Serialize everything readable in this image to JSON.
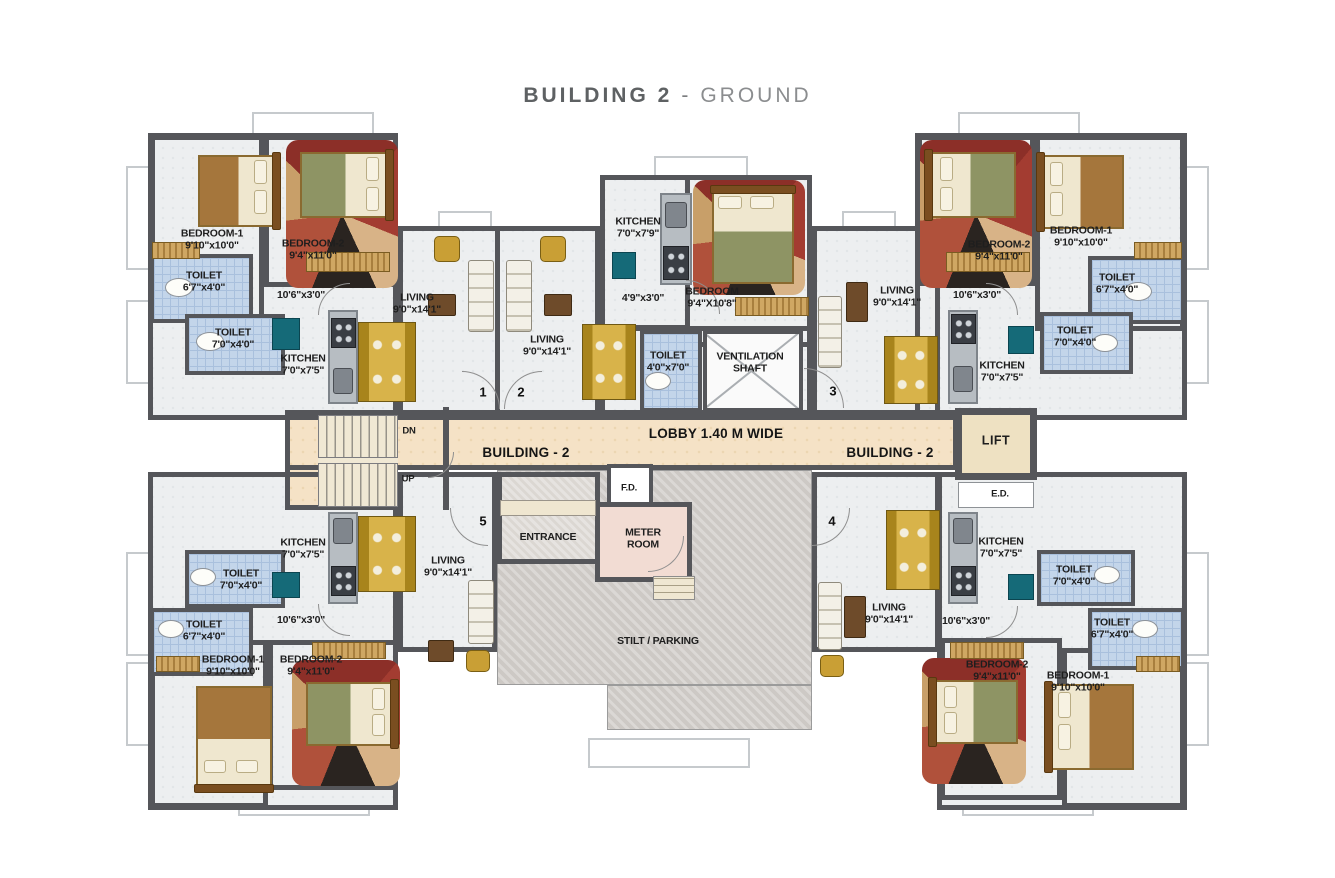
{
  "title": {
    "building": "BUILDING 2",
    "separator": "-",
    "floor": "GROUND"
  },
  "colors": {
    "wall": "#55565a",
    "lobby_floor": "#f5e2c6",
    "stilt_floor": "#cdc9c5",
    "toilet_tile": "#c3d5ea",
    "meter_room": "#f2dcd3",
    "lift_floor": "#eee1c2",
    "accent_gold": "#d8b34a",
    "accent_teal": "#156a78",
    "title_dark": "#5e6163",
    "title_light": "#8b8d8f"
  },
  "floorplan": {
    "unit_doors": [
      {
        "number": "1",
        "x": 483,
        "y": 392
      },
      {
        "number": "2",
        "x": 521,
        "y": 392
      },
      {
        "number": "3",
        "x": 833,
        "y": 391
      },
      {
        "number": "4",
        "x": 832,
        "y": 521
      },
      {
        "number": "5",
        "x": 483,
        "y": 521
      }
    ],
    "labels": [
      {
        "lines": [
          "BEDROOM-1",
          "9'10\"x10'0\""
        ],
        "x": 212,
        "y": 240,
        "style": "room"
      },
      {
        "lines": [
          "BEDROOM-2",
          "9'4\"x11'0\""
        ],
        "x": 313,
        "y": 250,
        "style": "room"
      },
      {
        "lines": [
          "TOILET",
          "6'7\"x4'0\""
        ],
        "x": 204,
        "y": 282,
        "style": "room"
      },
      {
        "lines": [
          "TOILET",
          "7'0\"x4'0\""
        ],
        "x": 233,
        "y": 339,
        "style": "room"
      },
      {
        "lines": [
          "10'6\"x3'0\""
        ],
        "x": 301,
        "y": 295,
        "style": "room"
      },
      {
        "lines": [
          "KITCHEN",
          "7'0\"x7'5\""
        ],
        "x": 303,
        "y": 365,
        "style": "room"
      },
      {
        "lines": [
          "LIVING",
          "9'0\"x14'1\""
        ],
        "x": 417,
        "y": 304,
        "style": "room"
      },
      {
        "lines": [
          "LIVING",
          "9'0\"x14'1\""
        ],
        "x": 547,
        "y": 346,
        "style": "room"
      },
      {
        "lines": [
          "KITCHEN",
          "7'0\"x7'9\""
        ],
        "x": 638,
        "y": 228,
        "style": "room"
      },
      {
        "lines": [
          "4'9\"x3'0\""
        ],
        "x": 643,
        "y": 298,
        "style": "room"
      },
      {
        "lines": [
          "BEDROOM",
          "9'4\"X10'8\""
        ],
        "x": 712,
        "y": 298,
        "style": "room"
      },
      {
        "lines": [
          "TOILET",
          "4'0\"x7'0\""
        ],
        "x": 668,
        "y": 362,
        "style": "room"
      },
      {
        "lines": [
          "VENTILATION",
          "SHAFT"
        ],
        "x": 750,
        "y": 363,
        "style": "room"
      },
      {
        "lines": [
          "LIVING",
          "9'0\"x14'1\""
        ],
        "x": 897,
        "y": 297,
        "style": "room"
      },
      {
        "lines": [
          "10'6\"x3'0\""
        ],
        "x": 977,
        "y": 295,
        "style": "room"
      },
      {
        "lines": [
          "BEDROOM-2",
          "9'4\"x11'0\""
        ],
        "x": 999,
        "y": 251,
        "style": "room"
      },
      {
        "lines": [
          "BEDROOM-1",
          "9'10\"x10'0\""
        ],
        "x": 1081,
        "y": 237,
        "style": "room"
      },
      {
        "lines": [
          "TOILET",
          "6'7\"x4'0\""
        ],
        "x": 1117,
        "y": 284,
        "style": "room"
      },
      {
        "lines": [
          "TOILET",
          "7'0\"x4'0\""
        ],
        "x": 1075,
        "y": 337,
        "style": "room"
      },
      {
        "lines": [
          "KITCHEN",
          "7'0\"x7'5\""
        ],
        "x": 1002,
        "y": 372,
        "style": "room"
      },
      {
        "lines": [
          "LOBBY 1.40 M WIDE"
        ],
        "x": 716,
        "y": 434,
        "style": "big"
      },
      {
        "lines": [
          "BUILDING - 2"
        ],
        "x": 526,
        "y": 453,
        "style": "big"
      },
      {
        "lines": [
          "BUILDING - 2"
        ],
        "x": 890,
        "y": 453,
        "style": "big"
      },
      {
        "lines": [
          "LIFT"
        ],
        "x": 996,
        "y": 441,
        "style": "med"
      },
      {
        "lines": [
          "DN"
        ],
        "x": 409,
        "y": 431,
        "style": "sm"
      },
      {
        "lines": [
          "UP"
        ],
        "x": 408,
        "y": 479,
        "style": "sm"
      },
      {
        "lines": [
          "F.D."
        ],
        "x": 629,
        "y": 488,
        "style": "sm"
      },
      {
        "lines": [
          "E.D."
        ],
        "x": 1000,
        "y": 494,
        "style": "sm"
      },
      {
        "lines": [
          "ENTRANCE"
        ],
        "x": 548,
        "y": 537,
        "style": "room"
      },
      {
        "lines": [
          "METER",
          "ROOM"
        ],
        "x": 643,
        "y": 539,
        "style": "room"
      },
      {
        "lines": [
          "STILT / PARKING"
        ],
        "x": 658,
        "y": 641,
        "style": "room"
      },
      {
        "lines": [
          "KITCHEN",
          "7'0\"x7'5\""
        ],
        "x": 303,
        "y": 549,
        "style": "room"
      },
      {
        "lines": [
          "TOILET",
          "7'0\"x4'0\""
        ],
        "x": 241,
        "y": 580,
        "style": "room"
      },
      {
        "lines": [
          "TOILET",
          "6'7\"x4'0\""
        ],
        "x": 204,
        "y": 631,
        "style": "room"
      },
      {
        "lines": [
          "10'6\"x3'0\""
        ],
        "x": 301,
        "y": 620,
        "style": "room"
      },
      {
        "lines": [
          "BEDROOM-1",
          "9'10\"x10'0\""
        ],
        "x": 233,
        "y": 666,
        "style": "room"
      },
      {
        "lines": [
          "BEDROOM-2",
          "9'4\"x11'0\""
        ],
        "x": 311,
        "y": 666,
        "style": "room"
      },
      {
        "lines": [
          "LIVING",
          "9'0\"x14'1\""
        ],
        "x": 448,
        "y": 567,
        "style": "room"
      },
      {
        "lines": [
          "LIVING",
          "9'0\"x14'1\""
        ],
        "x": 889,
        "y": 614,
        "style": "room"
      },
      {
        "lines": [
          "10'6\"x3'0\""
        ],
        "x": 966,
        "y": 621,
        "style": "room"
      },
      {
        "lines": [
          "KITCHEN",
          "7'0\"x7'5\""
        ],
        "x": 1001,
        "y": 548,
        "style": "room"
      },
      {
        "lines": [
          "TOILET",
          "7'0\"x4'0\""
        ],
        "x": 1074,
        "y": 576,
        "style": "room"
      },
      {
        "lines": [
          "TOILET",
          "6'7\"x4'0\""
        ],
        "x": 1112,
        "y": 629,
        "style": "room"
      },
      {
        "lines": [
          "BEDROOM-2",
          "9'4\"x11'0\""
        ],
        "x": 997,
        "y": 671,
        "style": "room"
      },
      {
        "lines": [
          "BEDROOM-1",
          "9'10\"x10'0\""
        ],
        "x": 1078,
        "y": 682,
        "style": "room"
      }
    ]
  }
}
